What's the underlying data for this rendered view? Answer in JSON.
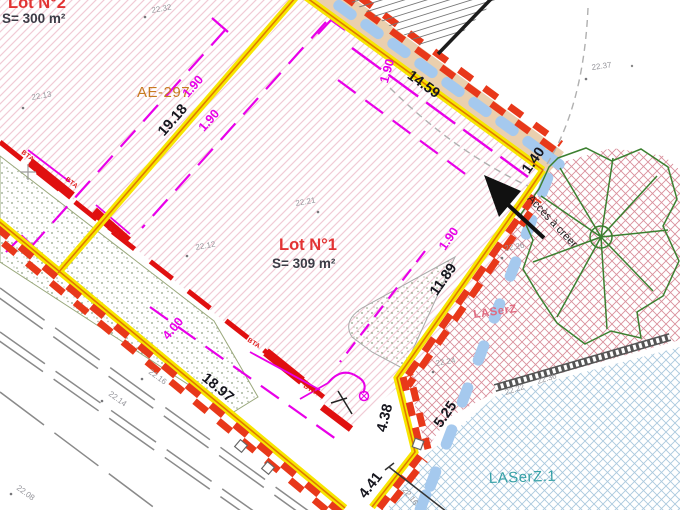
{
  "plan": {
    "lot2": {
      "name": "Lot N°2",
      "area": "S= 300 m²"
    },
    "lot1": {
      "name": "Lot N°1",
      "area": "S= 309 m²"
    },
    "parcel_ref": "AE-297",
    "access_label": "Accès à créer",
    "zone_labels": {
      "laserz": "LASerZ",
      "laserz1": "LASerZ.1"
    }
  },
  "dimensions_m": [
    {
      "t": "19.18",
      "x": 176,
      "y": 123,
      "r": -49
    },
    {
      "t": "14.59",
      "x": 421,
      "y": 88,
      "r": 36
    },
    {
      "t": "1.40",
      "x": 537,
      "y": 163,
      "r": -55
    },
    {
      "t": "11.89",
      "x": 447,
      "y": 282,
      "r": -55
    },
    {
      "t": "5.25",
      "x": 449,
      "y": 417,
      "r": -55
    },
    {
      "t": "4.38",
      "x": 389,
      "y": 419,
      "r": -76
    },
    {
      "t": "4.41",
      "x": 374,
      "y": 488,
      "r": -52
    },
    {
      "t": "18.97",
      "x": 215,
      "y": 391,
      "r": 40
    }
  ],
  "setback_dimensions_m": [
    {
      "t": "1.90",
      "x": 196,
      "y": 89,
      "r": -49
    },
    {
      "t": "1.90",
      "x": 212,
      "y": 123,
      "r": -49
    },
    {
      "t": "1.90",
      "x": 391,
      "y": 72,
      "r": -74
    },
    {
      "t": "1.90",
      "x": 452,
      "y": 241,
      "r": -55
    },
    {
      "t": "4.00",
      "x": 176,
      "y": 331,
      "r": -50
    }
  ],
  "elevation_points": [
    {
      "t": "22.32",
      "x": 152,
      "y": 13,
      "r": -10,
      "dx": 145,
      "dy": 17
    },
    {
      "t": "22.13",
      "x": 32,
      "y": 100,
      "r": -10,
      "dx": 23,
      "dy": 108
    },
    {
      "t": "22.37",
      "x": 592,
      "y": 70,
      "r": -8,
      "dx": 586,
      "dy": 79
    },
    {
      "t": "22.21",
      "x": 296,
      "y": 206,
      "r": -10,
      "dx": 318,
      "dy": 212
    },
    {
      "t": "22.12",
      "x": 196,
      "y": 250,
      "r": -10,
      "dx": 187,
      "dy": 256
    },
    {
      "t": "22.26",
      "x": 505,
      "y": 251,
      "r": -10,
      "dx": 502,
      "dy": 258
    },
    {
      "t": "22.24",
      "x": 436,
      "y": 366,
      "r": -10,
      "dx": 433,
      "dy": 372
    },
    {
      "t": "22.16",
      "x": 148,
      "y": 373,
      "r": 36,
      "dx": 142,
      "dy": 379
    },
    {
      "t": "22.14",
      "x": 108,
      "y": 395,
      "r": 36,
      "dx": 102,
      "dy": 401
    },
    {
      "t": "22.08",
      "x": 16,
      "y": 489,
      "r": 36,
      "dx": 11,
      "dy": 494
    },
    {
      "t": "22.22",
      "x": 506,
      "y": 395,
      "r": -18
    },
    {
      "t": "22.36",
      "x": 538,
      "y": 384,
      "r": -18
    },
    {
      "t": "22.16",
      "x": 402,
      "y": 490,
      "r": 52
    }
  ],
  "utility_labels": [
    {
      "t": "BTA",
      "x": 21,
      "y": 153,
      "r": 38
    },
    {
      "t": "BTA",
      "x": 65,
      "y": 180,
      "r": 38
    },
    {
      "t": "BTA",
      "x": 107,
      "y": 229,
      "r": 38
    },
    {
      "t": "BTA",
      "x": 247,
      "y": 341,
      "r": 33
    },
    {
      "t": "BTA",
      "x": 303,
      "y": 387,
      "r": 33
    }
  ],
  "colors": {
    "boundary_yellow": "#f7e600",
    "boundary_red": "#e8381a",
    "division_orange": "#e07800",
    "setback_magenta": "#e800e8",
    "utility_red": "#e01010",
    "hatch_pink": "#f1cbd5",
    "grid_pink": "#d9909c",
    "grid_blue": "#abc9de",
    "path_tan": "#eacfae",
    "path_blue": "#a5c9ee",
    "vegetation_green": "#3c8030",
    "zone_teal": "#35a0a6",
    "zone_pink": "#e06a80",
    "parcel_orange": "#c87a20",
    "lot_red": "#e23333"
  }
}
